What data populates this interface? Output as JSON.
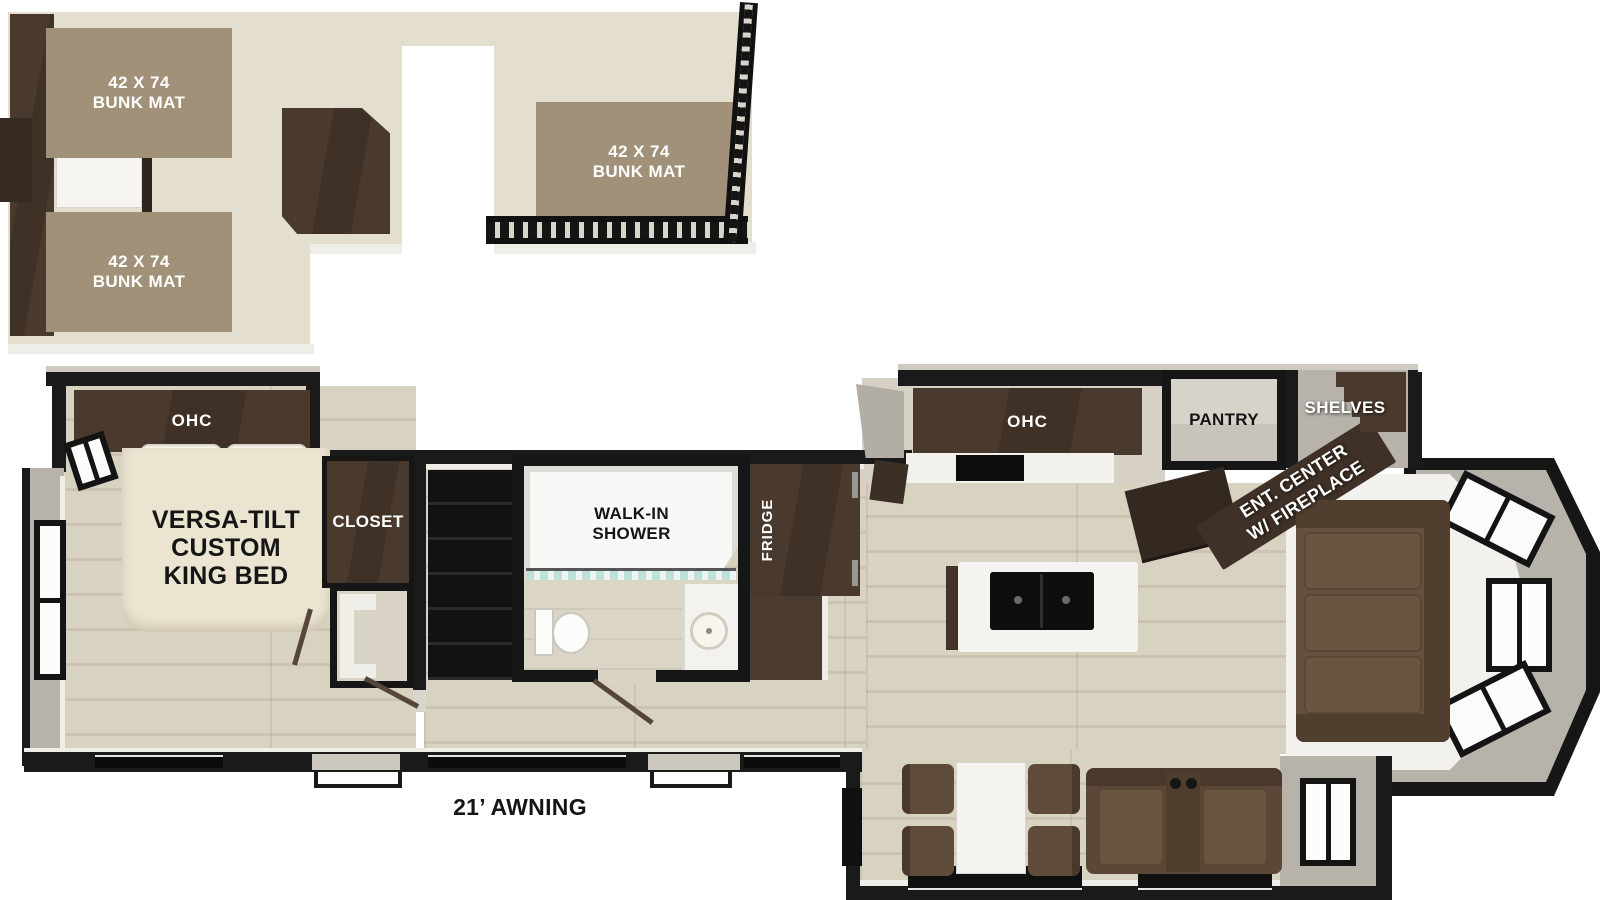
{
  "loft": {
    "bunk_mats": [
      {
        "size": "42 X 74",
        "name": "BUNK MAT"
      },
      {
        "size": "42 X 74",
        "name": "BUNK MAT"
      },
      {
        "size": "42 X 74",
        "name": "BUNK MAT"
      }
    ]
  },
  "bedroom": {
    "ohc_label": "OHC",
    "bed_lines": [
      "VERSA-TILT",
      "CUSTOM",
      "KING BED"
    ],
    "closet_label": "CLOSET"
  },
  "bathroom": {
    "shower_lines": [
      "WALK-IN",
      "SHOWER"
    ]
  },
  "kitchen": {
    "fridge_label": "FRIDGE",
    "ohc_label": "OHC",
    "pantry_label": "PANTRY",
    "shelves_label": "SHELVES"
  },
  "living": {
    "ent_center_lines": [
      "ENT. CENTER",
      "W/ FIREPLACE"
    ]
  },
  "exterior": {
    "awning_label": "21’ AWNING"
  },
  "colors": {
    "wall_black": "#1a1a1a",
    "wood_floor": "#d8d2c1",
    "loft_floor": "#e4decf",
    "bunk_mat": "#a29179",
    "dark_cabinet": "#46362b",
    "bed_cream": "#ebe4d1",
    "sofa_brown": "#63503e",
    "counter_white": "#f3f2ef",
    "wall_gray": "#b7b3aa",
    "glass_teal": "#bfe0da"
  }
}
